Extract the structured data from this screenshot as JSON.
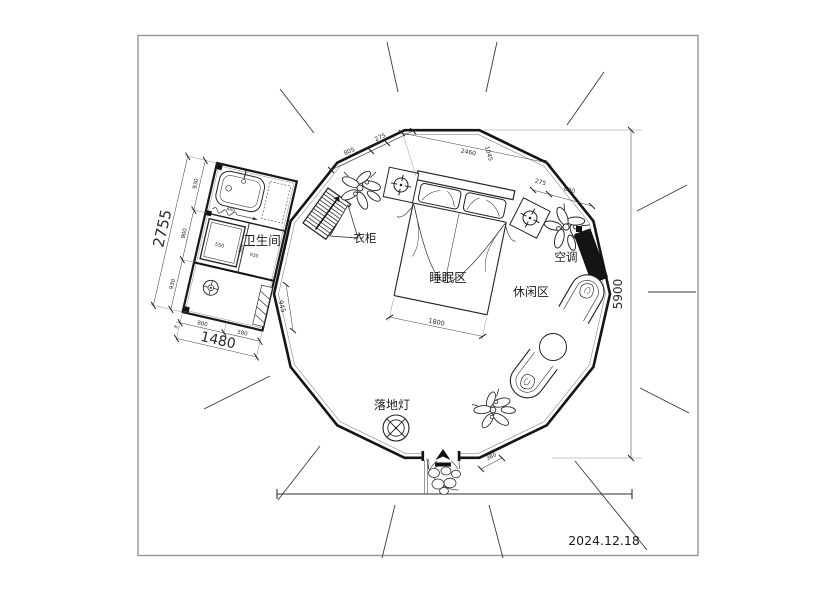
{
  "meta": {
    "date": "2024.12.18"
  },
  "rooms": {
    "bathroom": "卫生间",
    "wardrobe": "衣柜",
    "sleeping_area": "睡眠区",
    "leisure_area": "休闲区",
    "air_conditioner": "空调",
    "floor_lamp": "落地灯"
  },
  "dims": {
    "overall_height": "5900",
    "top_805": "805",
    "top_275_left": "275",
    "top_2460": "2460",
    "top_1045": "1045",
    "top_275_right": "275",
    "top_690": "690",
    "bed_width": "1800",
    "entrance_offset": "380",
    "connector_945": "945",
    "bath_left_930_top": "930",
    "bath_left_900": "900",
    "bath_left_930_bottom": "930",
    "bath_left_total": "2755",
    "bath_bottom_800": "800",
    "bath_bottom_580": "580",
    "bath_bottom_total": "1480",
    "bath_bottom_90": "90",
    "bath_inner_400": "400",
    "bath_inner_550": "550",
    "bath_inner_900": "900",
    "bath_inner_930": "930"
  }
}
